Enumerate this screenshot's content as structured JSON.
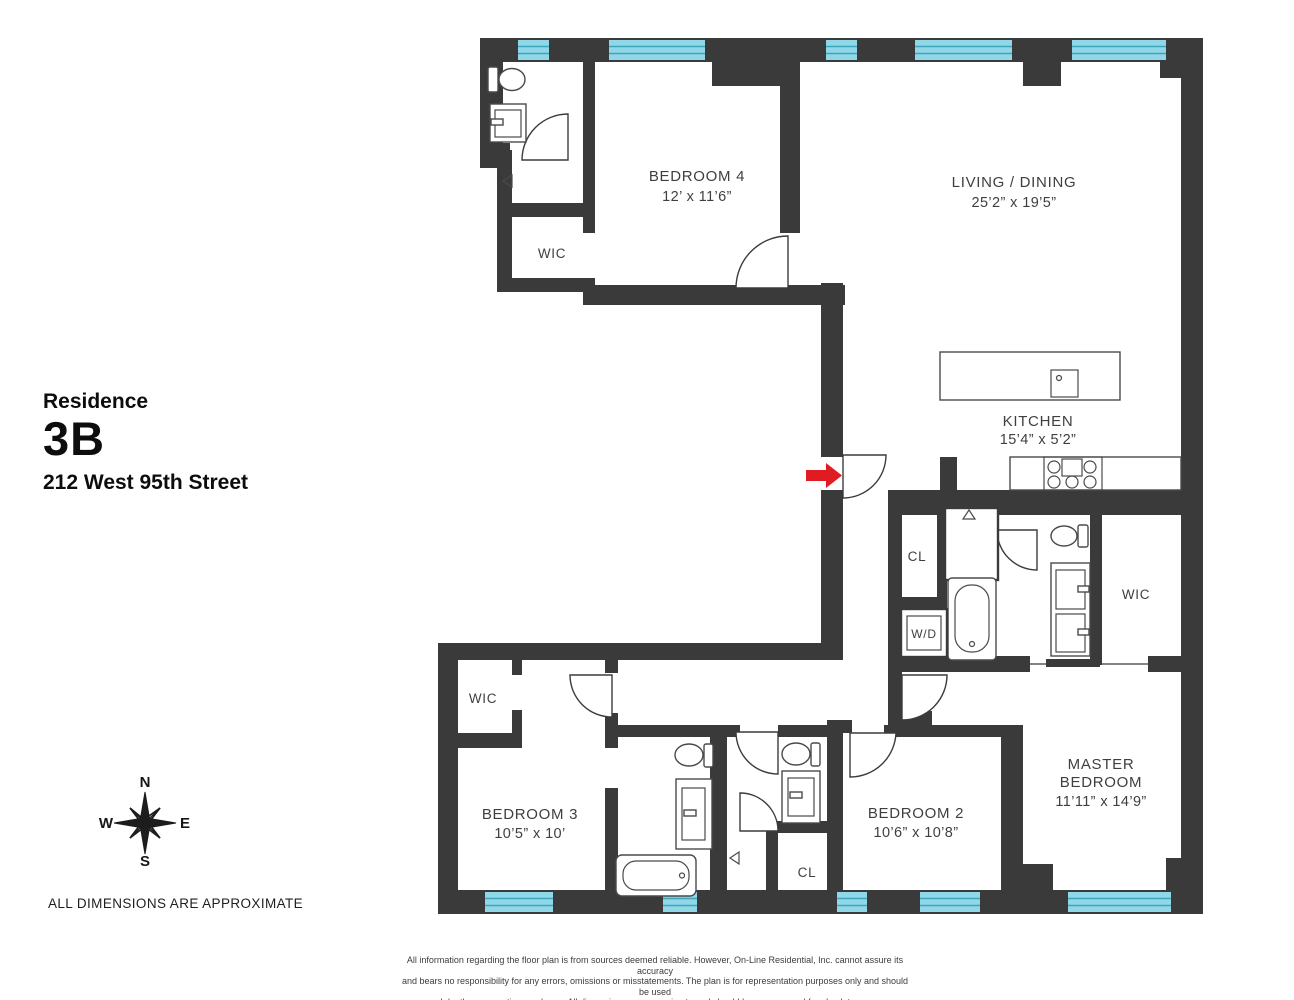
{
  "title_block": {
    "label": "Residence",
    "unit": "3B",
    "address": "212 West 95th Street"
  },
  "compass": {
    "north": "N",
    "east": "E",
    "south": "S",
    "west": "W"
  },
  "note": "ALL DIMENSIONS ARE APPROXIMATE",
  "disclaimer": {
    "line1": "All information regarding the floor plan is from sources deemed reliable. However, On-Line Residential, Inc. cannot assure its accuracy",
    "line2": "and bears no responsibility for any errors, omissions or misstatements. The plan is for representation purposes only and should be used",
    "line3": "as such by the prospective purchaser. All dimensions are approximate and should be re-measured for absolute accuracy."
  },
  "rooms": {
    "bedroom4": {
      "name": "BEDROOM 4",
      "dims": "12’ x 11’6”"
    },
    "living_dining": {
      "name": "LIVING / DINING",
      "dims": "25’2” x 19’5”"
    },
    "kitchen": {
      "name": "KITCHEN",
      "dims": "15’4” x 5’2”"
    },
    "bedroom3": {
      "name": "BEDROOM 3",
      "dims": "10’5” x 10’"
    },
    "bedroom2": {
      "name": "BEDROOM 2",
      "dims": "10’6” x 10’8”"
    },
    "master_bedroom": {
      "name_line1": "MASTER",
      "name_line2": "BEDROOM",
      "dims": "11’11” x 14’9”"
    }
  },
  "closets": {
    "wic_bed4": "WIC",
    "wic_master": "WIC",
    "wic_bed3": "WIC",
    "cl_hall": "CL",
    "cl_bed2": "CL",
    "washer_dryer": "W/D"
  },
  "colors": {
    "wall": "#3a3a3a",
    "window_fill": "#90d7e7",
    "window_stripe": "#3fa5bd",
    "entry_arrow": "#e11b22",
    "label_text": "#3f3f3f"
  }
}
